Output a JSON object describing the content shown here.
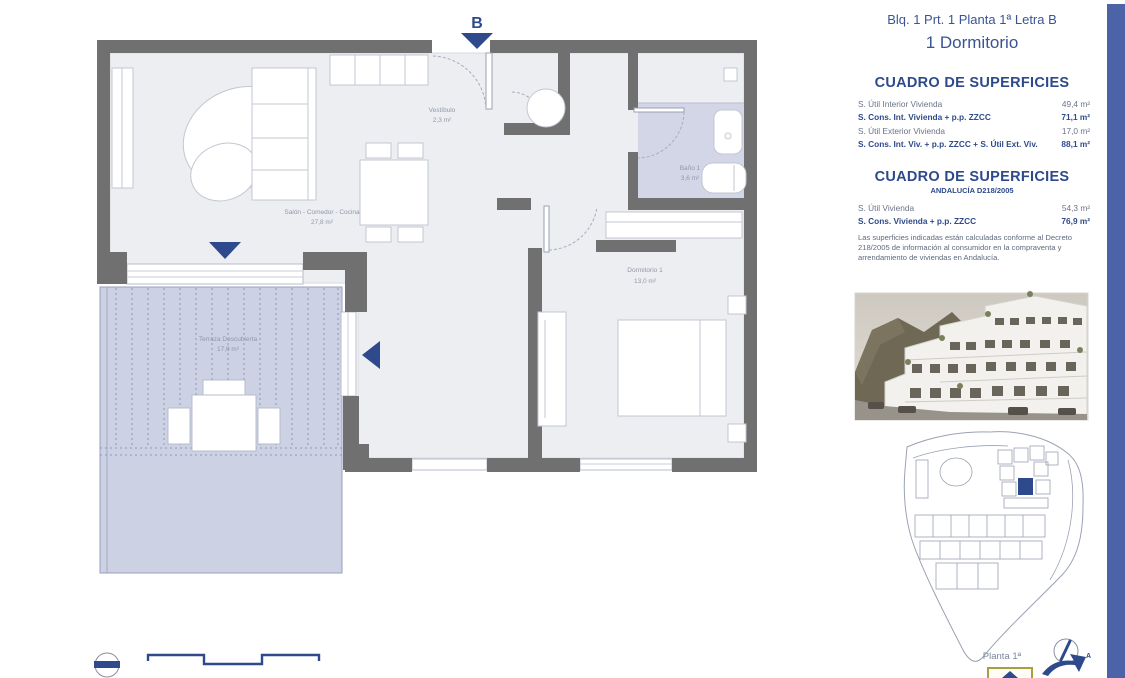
{
  "header": {
    "location": "Blq. 1 Prt. 1 Planta 1ª Letra B",
    "unit_type": "1 Dormitorio"
  },
  "surface_table_primary": {
    "title": "CUADRO DE SUPERFICIES",
    "rows": [
      {
        "label": "S. Útil Interior Vivienda",
        "value": "49,4 m²"
      },
      {
        "label": "S. Cons. Int. Vivienda + p.p. ZZCC",
        "value": "71,1 m²"
      },
      {
        "label": "S. Útil Exterior Vivienda",
        "value": "17,0 m²"
      },
      {
        "label": "S. Cons. Int. Viv. + p.p. ZZCC + S. Útil Ext. Viv.",
        "value": "88,1 m²"
      }
    ]
  },
  "surface_table_andalucia": {
    "title": "CUADRO DE SUPERFICIES",
    "subtitle": "ANDALUCÍA D218/2005",
    "rows": [
      {
        "label": "S. Útil Vivienda",
        "value": "54,3 m²"
      },
      {
        "label": "S. Cons. Vivienda + p.p. ZZCC",
        "value": "76,9 m²"
      }
    ],
    "note": "Las superficies indicadas están calculadas conforme al Decreto 218/2005 de información al consumidor en la compraventa y arrendamiento de viviendas en Andalucía."
  },
  "floor_plan": {
    "section_marker": "B",
    "rooms": {
      "vestibulo": {
        "name": "Vestíbulo",
        "area": "2,3 m²"
      },
      "salon": {
        "name": "Salón - Comedor - Cocina",
        "area": "27,8 m²"
      },
      "bano": {
        "name": "Baño 1",
        "area": "3,6 m²"
      },
      "dormitorio": {
        "name": "Dormitorio 1",
        "area": "13,0 m²"
      },
      "terraza": {
        "name": "Terraza Descubierta",
        "area": "17,0 m²"
      }
    }
  },
  "site_plan": {
    "caption": "Planta 1ª",
    "logo_letter": "A"
  },
  "colors": {
    "accent_bar": "#4c63a8",
    "navy": "#2e4a8c",
    "wall_gray": "#707070",
    "floor_gray": "#edeef1",
    "wet_lavender": "#d3d6e7",
    "terrace_lavender": "#ccd1e3"
  }
}
